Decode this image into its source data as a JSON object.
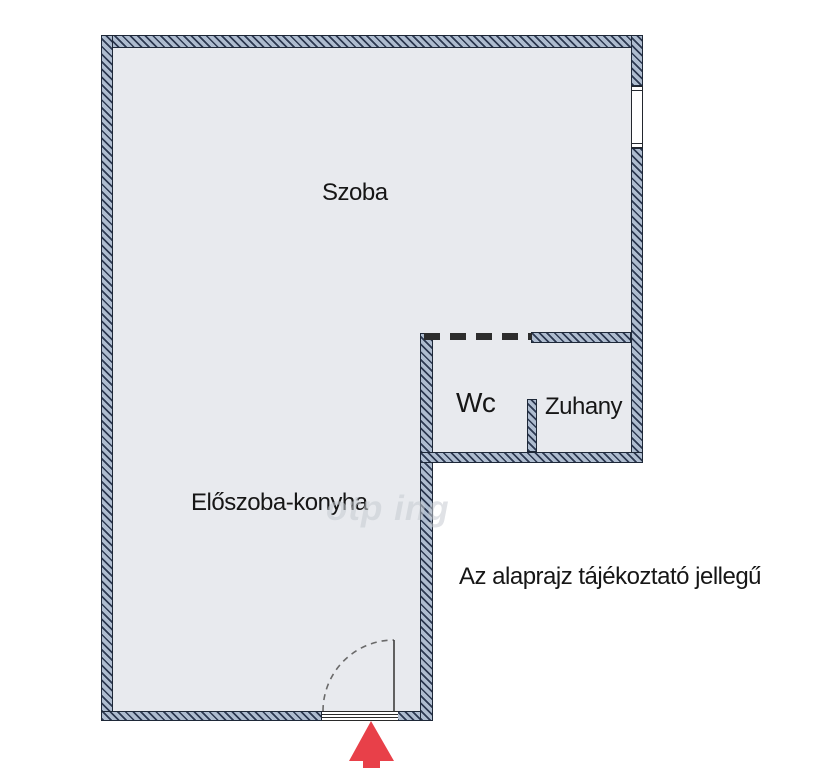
{
  "plan": {
    "rooms": [
      {
        "name": "szoba",
        "label": "Szoba"
      },
      {
        "name": "wc",
        "label": "Wc"
      },
      {
        "name": "zuhany",
        "label": "Zuhany"
      },
      {
        "name": "eloszoba-konyha",
        "label": "Előszoba-konyha"
      }
    ],
    "disclaimer": "Az alaprajz tájékoztató jellegű",
    "watermark": "otp ing",
    "symbols": {
      "entrance_arrow": "up-arrow",
      "door": "quarter-circle-swing",
      "window": "double-line-window",
      "opening": "dashed-line"
    },
    "colors": {
      "wall_fill": "#aebccf",
      "wall_hatch": "#2c3850",
      "wall_border": "#1e2838",
      "floor": "#e8eaee",
      "entrance_arrow": "#e84049",
      "dash": "#2d2d2d",
      "background": "#ffffff"
    }
  }
}
